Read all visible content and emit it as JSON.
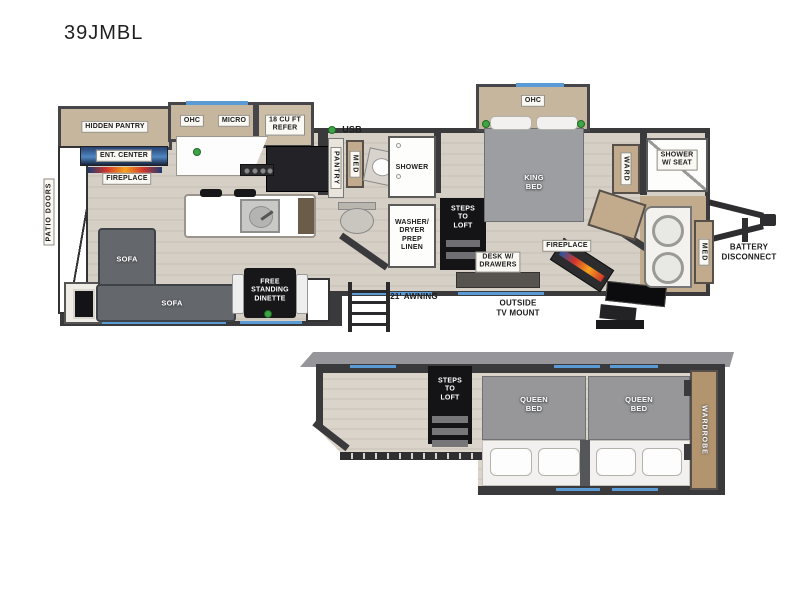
{
  "title": "39JMBL",
  "legend": {
    "usb": "USB"
  },
  "main_floor": {
    "exterior": {
      "patio_doors": "PATIO DOORS",
      "awning": "21' AWNING",
      "outside_tv_mount": "OUTSIDE\nTV MOUNT",
      "battery_disconnect": "BATTERY\nDISCONNECT"
    },
    "kitchen": {
      "hidden_pantry": "HIDDEN PANTRY",
      "ohc": "OHC",
      "micro": "MICRO",
      "refrigerator": "18 CU FT\nREFER",
      "ent_center": "ENT. CENTER",
      "fireplace": "FIREPLACE"
    },
    "living": {
      "sofa_side": "SOFA",
      "sofa_rear": "SOFA",
      "dinette": "FREE\nSTANDING\nDINETTE"
    },
    "bathroom": {
      "pantry": "PANTRY",
      "med": "MED",
      "shower": "SHOWER",
      "washer_dryer": "WASHER/\nDRYER\nPREP\nLINEN",
      "steps_to_loft": "STEPS\nTO\nLOFT"
    },
    "bedroom": {
      "ohc": "OHC",
      "king_bed": "KING\nBED",
      "ward": "WARD",
      "fireplace": "FIREPLACE",
      "desk": "DESK W/\nDRAWERS"
    },
    "front_bath": {
      "shower_w_seat": "SHOWER\nW/ SEAT",
      "med": "MED"
    }
  },
  "loft": {
    "steps_to_loft": "STEPS\nTO\nLOFT",
    "queen_bed_left": "QUEEN\nBED",
    "queen_bed_right": "QUEEN\nBED",
    "wardrobe": "WARDROBE"
  },
  "colors": {
    "wall": "#3a3a3c",
    "floor_wood": "#d2cbc2",
    "cabinet_tan": "#c2ab8d",
    "accent_blue": "#5b9bd5",
    "marker_green": "#3da545",
    "sofa_gray": "#64676b",
    "bed_gray": "#97979a"
  }
}
